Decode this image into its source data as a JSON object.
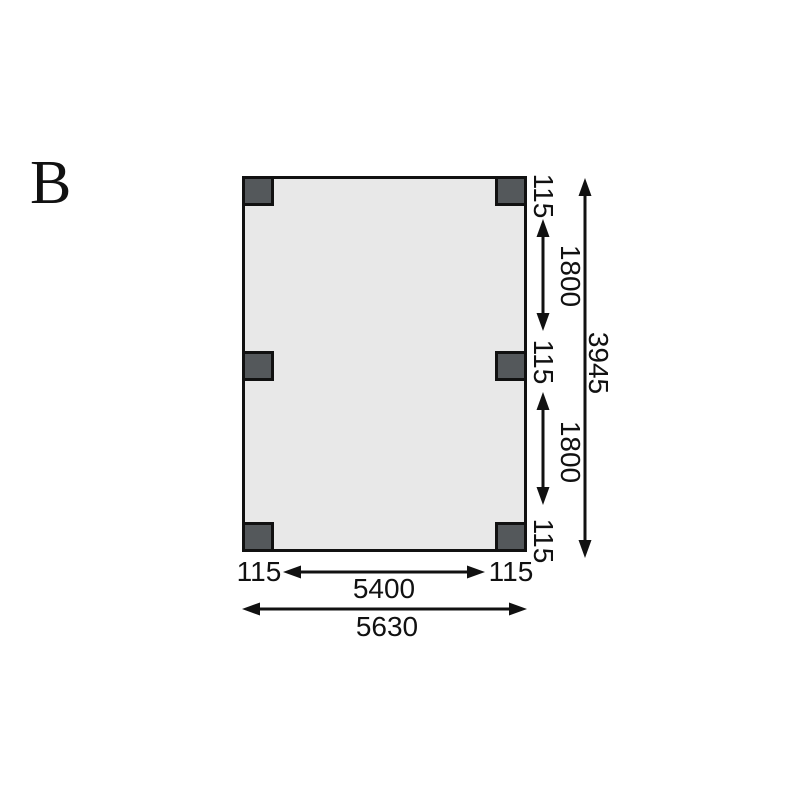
{
  "title": {
    "label": "B"
  },
  "colors": {
    "background": "#ffffff",
    "plan_fill": "#e8e8e8",
    "post_fill": "#54585b",
    "line": "#111111"
  },
  "plan": {
    "type": "floor-plan-top-view",
    "post_count": 6,
    "post_positions": [
      "top-left",
      "top-right",
      "middle-left",
      "middle-right",
      "bottom-left",
      "bottom-right"
    ]
  },
  "dims": {
    "bottom_left_offset": "115",
    "bottom_span": "5400",
    "bottom_right_offset": "115",
    "bottom_total": "5630",
    "right_top_offset": "115",
    "right_upper_span": "1800",
    "right_middle_offset": "115",
    "right_lower_span": "1800",
    "right_bottom_offset": "115",
    "right_total": "3945"
  }
}
